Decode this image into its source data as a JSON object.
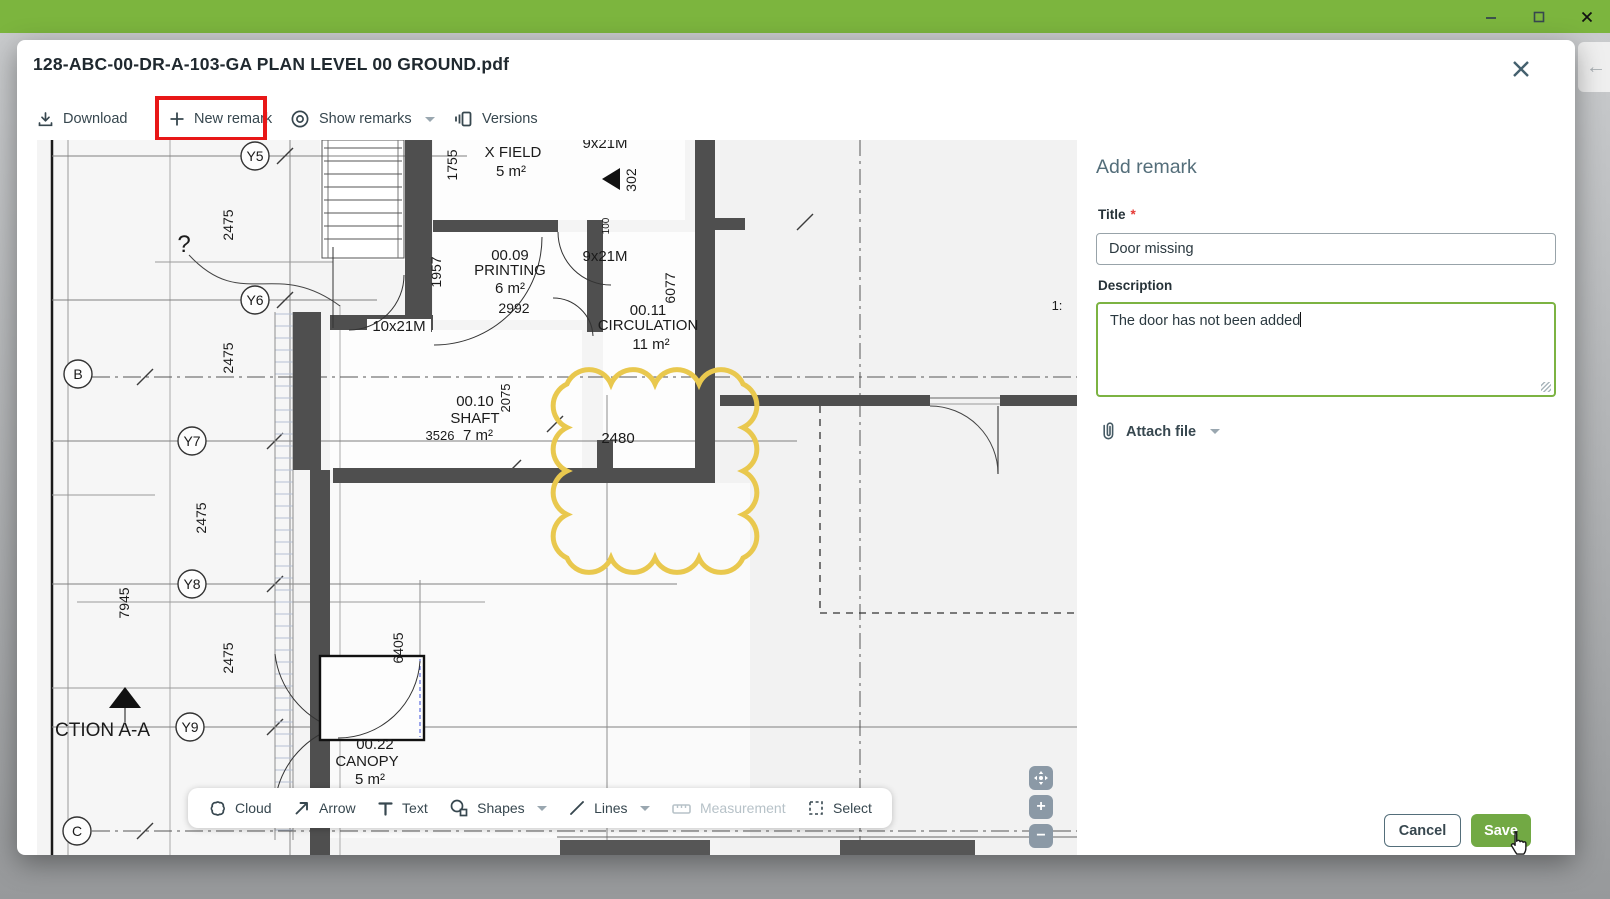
{
  "window": {
    "controls": {
      "minimize": "–",
      "maximize": "",
      "close": "×"
    }
  },
  "modal": {
    "title": "128-ABC-00-DR-A-103-GA PLAN LEVEL 00 GROUND.pdf",
    "close_icon": "×",
    "back_icon": "←"
  },
  "toolbar": {
    "download_label": "Download",
    "new_remark_label": "New remark",
    "show_remarks_label": "Show remarks",
    "versions_label": "Versions"
  },
  "plan": {
    "labels": [
      {
        "t": "9x21M",
        "x": 568,
        "y": 8,
        "s": 15
      },
      {
        "t": "X FIELD",
        "x": 476,
        "y": 17,
        "s": 15
      },
      {
        "t": "5 m²",
        "x": 474,
        "y": 36,
        "s": 15
      },
      {
        "t": "302",
        "x": 599,
        "y": 40,
        "s": 14,
        "r": 1
      },
      {
        "t": "1755",
        "x": 420,
        "y": 25,
        "s": 14,
        "r": 1
      },
      {
        "t": "100",
        "x": 572,
        "y": 86,
        "s": 10,
        "r": 1
      },
      {
        "t": "00.09",
        "x": 473,
        "y": 120,
        "s": 15
      },
      {
        "t": "PRINTING",
        "x": 473,
        "y": 135,
        "s": 15
      },
      {
        "t": "6 m²",
        "x": 473,
        "y": 153,
        "s": 15
      },
      {
        "t": "2992",
        "x": 477,
        "y": 173,
        "s": 14
      },
      {
        "t": "9x21M",
        "x": 568,
        "y": 121,
        "s": 15
      },
      {
        "t": "1957",
        "x": 404,
        "y": 132,
        "s": 14,
        "r": 1
      },
      {
        "t": "6077",
        "x": 638,
        "y": 148,
        "s": 14,
        "r": 1
      },
      {
        "t": "00.11",
        "x": 611,
        "y": 175,
        "s": 15
      },
      {
        "t": "CIRCULATION",
        "x": 611,
        "y": 190,
        "s": 15
      },
      {
        "t": "11 m²",
        "x": 614,
        "y": 209,
        "s": 15
      },
      {
        "t": "10x21M",
        "x": 362,
        "y": 191,
        "s": 15
      },
      {
        "t": "00.10",
        "x": 438,
        "y": 266,
        "s": 15
      },
      {
        "t": "SHAFT",
        "x": 438,
        "y": 283,
        "s": 15
      },
      {
        "t": "3526",
        "x": 403,
        "y": 300,
        "s": 13
      },
      {
        "t": "7 m²",
        "x": 441,
        "y": 300,
        "s": 15
      },
      {
        "t": "2075",
        "x": 473,
        "y": 258,
        "s": 13,
        "r": 1
      },
      {
        "t": "2480",
        "x": 581,
        "y": 303,
        "s": 15
      },
      {
        "t": "2475",
        "x": 196,
        "y": 85,
        "s": 14,
        "r": 1
      },
      {
        "t": "2475",
        "x": 196,
        "y": 218,
        "s": 14,
        "r": 1
      },
      {
        "t": "2475",
        "x": 169,
        "y": 378,
        "s": 14,
        "r": 1
      },
      {
        "t": "2475",
        "x": 196,
        "y": 518,
        "s": 14,
        "r": 1
      },
      {
        "t": "7945",
        "x": 92,
        "y": 463,
        "s": 14,
        "r": 1
      },
      {
        "t": "6405",
        "x": 366,
        "y": 508,
        "s": 14,
        "r": 1
      },
      {
        "t": "5",
        "x": 182,
        "y": 652,
        "s": 14,
        "r": 1
      },
      {
        "t": "?",
        "x": 147,
        "y": 112,
        "s": 24
      },
      {
        "t": "CTION A-A",
        "x": 18,
        "y": 596,
        "s": 19,
        "anchor": "start"
      },
      {
        "t": "00.22",
        "x": 338,
        "y": 609,
        "s": 15
      },
      {
        "t": "CANOPY",
        "x": 330,
        "y": 626,
        "s": 15
      },
      {
        "t": "5 m²",
        "x": 333,
        "y": 644,
        "s": 15
      },
      {
        "t": "1:",
        "x": 1020,
        "y": 170,
        "s": 13
      }
    ],
    "grid_markers": [
      {
        "l": "Y5",
        "x": 218,
        "y": 16
      },
      {
        "l": "Y6",
        "x": 218,
        "y": 160
      },
      {
        "l": "B",
        "x": 41,
        "y": 234
      },
      {
        "l": "Y7",
        "x": 155,
        "y": 301
      },
      {
        "l": "Y8",
        "x": 155,
        "y": 444
      },
      {
        "l": "Y9",
        "x": 153,
        "y": 587
      },
      {
        "l": "C",
        "x": 40,
        "y": 691
      }
    ],
    "cloud_annotation_color": "#e9c84e"
  },
  "annotation_toolbar": {
    "items": [
      {
        "label": "Cloud",
        "enabled": true,
        "dropdown": false
      },
      {
        "label": "Arrow",
        "enabled": true,
        "dropdown": false
      },
      {
        "label": "Text",
        "enabled": true,
        "dropdown": false
      },
      {
        "label": "Shapes",
        "enabled": true,
        "dropdown": true
      },
      {
        "label": "Lines",
        "enabled": true,
        "dropdown": true
      },
      {
        "label": "Measurement",
        "enabled": false,
        "dropdown": false
      },
      {
        "label": "Select",
        "enabled": true,
        "dropdown": false
      }
    ]
  },
  "zoom_controls": {
    "zoom_in": "+",
    "zoom_out": "−"
  },
  "remark_panel": {
    "heading": "Add remark",
    "title_label": "Title",
    "required_mark": "*",
    "title_value": "Door missing",
    "description_label": "Description",
    "description_value": "The door has not been added",
    "attach_file_label": "Attach file",
    "cancel_label": "Cancel",
    "save_label": "Save"
  },
  "colors": {
    "titlebar_green": "#7cb53e",
    "save_green": "#72a944",
    "focus_green": "#7cb342",
    "highlight_red": "#e81717",
    "cloud_yellow": "#e9c84e"
  }
}
